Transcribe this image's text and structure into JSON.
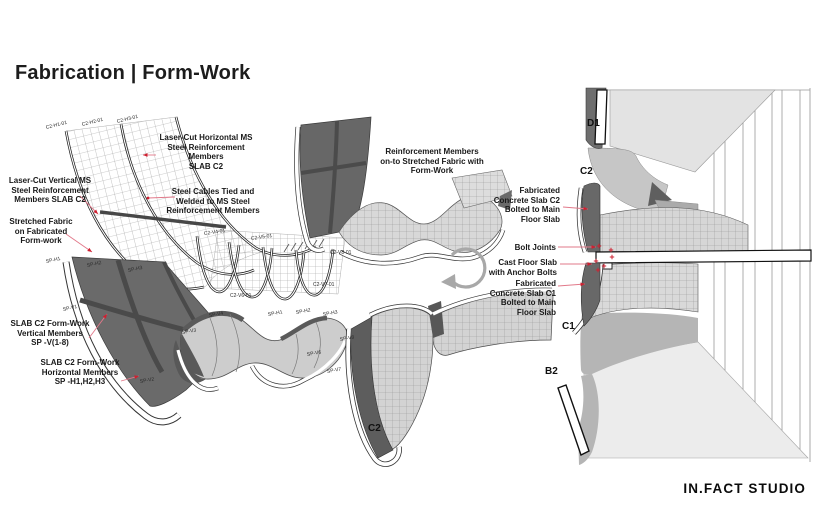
{
  "title": "Fabrication | Form-Work",
  "logo": "IN.FACT STUDIO",
  "colors": {
    "leader": "#e2798a",
    "arrow": "#cf2030",
    "ink": "#1c1c1c"
  },
  "callouts": [
    {
      "name": "callout-laser-cut-horizontal",
      "text": "Laser-Cut Horizontal MS\nSteel Reinforcement\nMembers\nSLAB C2",
      "cx": 206,
      "y": 133,
      "align": "center",
      "leader": [
        156,
        155,
        143,
        155
      ],
      "tip": "arrow"
    },
    {
      "name": "callout-laser-cut-vertical",
      "text": "Laser-Cut Vertical MS\nSteel Reinforcement\nMembers SLAB C2",
      "cx": 50,
      "y": 176,
      "align": "center",
      "leader": [
        80,
        196,
        98,
        214
      ],
      "tip": "arrow"
    },
    {
      "name": "callout-steel-cables",
      "text": "Steel Cables Tied and\nWelded to MS Steel\nReinforcement Members",
      "cx": 213,
      "y": 187,
      "align": "center",
      "leader": [
        175,
        197,
        148,
        198
      ],
      "tip": "dot"
    },
    {
      "name": "callout-stretched-fabric",
      "text": "Stretched Fabric\non Fabricated\nForm-work",
      "cx": 41,
      "y": 217,
      "align": "center",
      "leader": [
        66,
        234,
        92,
        252
      ],
      "tip": "arrow"
    },
    {
      "name": "callout-slab-vertical-members",
      "text": "SLAB C2 Form-Work\nVertical Members\nSP -V(1-8)",
      "cx": 50,
      "y": 319,
      "align": "center",
      "leader": [
        89,
        338,
        107,
        314
      ],
      "tip": "arrow"
    },
    {
      "name": "callout-slab-horizontal-members",
      "text": "SLAB C2 Form-Work\nHorizontal Members\nSP -H1,H2,H3",
      "cx": 80,
      "y": 358,
      "align": "center",
      "leader": [
        121,
        381,
        139,
        376
      ],
      "tip": "arrow"
    },
    {
      "name": "callout-reinforcement-members",
      "text": "Reinforcement Members\non-to Stretched Fabric with\nForm-Work",
      "cx": 432,
      "y": 147,
      "align": "center"
    },
    {
      "name": "callout-fabricated-slab-c2",
      "text": "Fabricated\nConcrete Slab C2\nBolted to Main\nFloor Slab",
      "rx": 560,
      "y": 186,
      "align": "right",
      "leader": [
        563,
        207,
        588,
        209
      ],
      "tip": "arrow"
    },
    {
      "name": "callout-bolt-joints",
      "text": "Bolt Joints",
      "rx": 556,
      "y": 243,
      "align": "right",
      "leader": [
        558,
        247,
        596,
        247
      ],
      "tip": "arrow"
    },
    {
      "name": "callout-cast-floor-slab",
      "text": "Cast Floor Slab\nwith Anchor Bolts",
      "rx": 557,
      "y": 258,
      "align": "right",
      "leader": [
        560,
        264,
        592,
        264
      ],
      "tip": "arrow"
    },
    {
      "name": "callout-fabricated-slab-c1",
      "text": "Fabricated\nConcrete Slab C1\nBolted to Main\nFloor Slab",
      "rx": 556,
      "y": 279,
      "align": "right",
      "leader": [
        558,
        286,
        585,
        284
      ],
      "tip": "arrow"
    }
  ],
  "part_labels": [
    {
      "t": "C2-H1-01",
      "x": 46,
      "y": 125,
      "r": -14
    },
    {
      "t": "C2-H2-01",
      "x": 82,
      "y": 122,
      "r": -14
    },
    {
      "t": "C2-H3-01",
      "x": 117,
      "y": 119,
      "r": -14
    },
    {
      "t": "C2-V4-01",
      "x": 204,
      "y": 231,
      "r": -8
    },
    {
      "t": "C2-V5-01",
      "x": 251,
      "y": 236,
      "r": -8
    },
    {
      "t": "C2-V8-01",
      "x": 330,
      "y": 250,
      "r": 0
    },
    {
      "t": "C2-V7-01",
      "x": 313,
      "y": 282,
      "r": 0
    },
    {
      "t": "C2-V6-01",
      "x": 230,
      "y": 293,
      "r": 0
    },
    {
      "t": "SP-H1",
      "x": 46,
      "y": 259,
      "r": -12
    },
    {
      "t": "SP-H2",
      "x": 87,
      "y": 263,
      "r": -12
    },
    {
      "t": "SP-H3",
      "x": 128,
      "y": 268,
      "r": -12
    },
    {
      "t": "SP-V1",
      "x": 63,
      "y": 307,
      "r": -12
    },
    {
      "t": "SP-V2",
      "x": 140,
      "y": 379,
      "r": -10
    },
    {
      "t": "SP-V3",
      "x": 182,
      "y": 330,
      "r": -10
    },
    {
      "t": "SP-V4",
      "x": 209,
      "y": 313,
      "r": -10
    },
    {
      "t": "SP-H1",
      "x": 268,
      "y": 312,
      "r": -10
    },
    {
      "t": "SP-H2",
      "x": 296,
      "y": 310,
      "r": -10
    },
    {
      "t": "SP-H3",
      "x": 323,
      "y": 312,
      "r": -10
    },
    {
      "t": "SP-V8",
      "x": 340,
      "y": 337,
      "r": -10
    },
    {
      "t": "SP-V6",
      "x": 307,
      "y": 352,
      "r": -10
    },
    {
      "t": "SP-V7",
      "x": 327,
      "y": 369,
      "r": -10
    },
    {
      "t": "D1",
      "x": 587,
      "y": 118,
      "r": 0,
      "cls": "id"
    },
    {
      "t": "C2",
      "x": 580,
      "y": 166,
      "r": 0,
      "cls": "id"
    },
    {
      "t": "C1",
      "x": 562,
      "y": 321,
      "r": 0,
      "cls": "id"
    },
    {
      "t": "B2",
      "x": 545,
      "y": 366,
      "r": 0,
      "cls": "id"
    },
    {
      "t": "C2",
      "x": 368,
      "y": 423,
      "r": 0,
      "cls": "id"
    }
  ],
  "markers": [
    [
      599,
      246
    ],
    [
      611,
      250
    ],
    [
      596,
      261
    ],
    [
      604,
      266
    ],
    [
      612,
      257
    ],
    [
      598,
      270
    ]
  ]
}
